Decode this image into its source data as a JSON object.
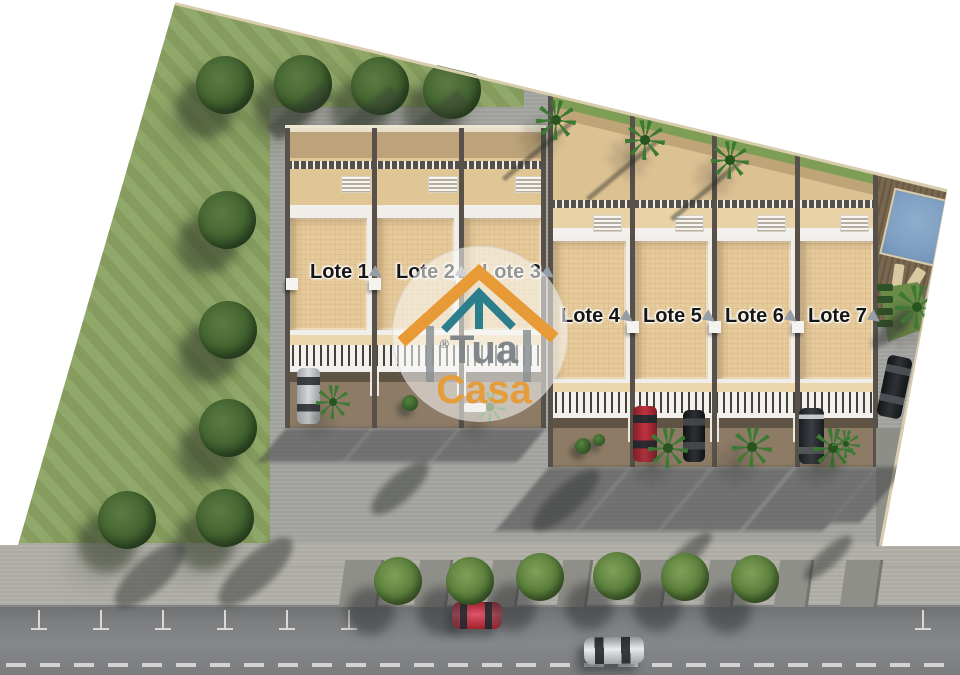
{
  "image_type": "residential-lots-site-plan-rendering",
  "lots": [
    {
      "label": "Lote 1"
    },
    {
      "label": "Lote 2"
    },
    {
      "label": "Lote 3"
    },
    {
      "label": "Lote 4"
    },
    {
      "label": "Lote 5"
    },
    {
      "label": "Lote 6"
    },
    {
      "label": "Lote 7"
    }
  ],
  "watermark": {
    "registered_symbol": "®",
    "brand_line1": "Tua",
    "brand_line2": "Casa"
  },
  "icons": {
    "lot_pointer": "arrow-down-right"
  },
  "palette": {
    "grass": "#8CA463",
    "field_tree": "#41632F",
    "concrete_apron": "#A4A4A0",
    "sidewalk": "#B1B0A8",
    "street": "#7E8082",
    "lane_dash": "#E2E2E0",
    "building_floor": "#E6CA9A",
    "backyard": "#E0C694",
    "carport_brown": "#8D7B66",
    "divider_wall": "#57514A",
    "pool_water": "#7E9FC2",
    "pool_deck": "#7A674F",
    "logo_orange": "#E89A36",
    "logo_teal": "#2D7E8D",
    "logo_gray": "#82878C",
    "label_text": "#161616"
  }
}
